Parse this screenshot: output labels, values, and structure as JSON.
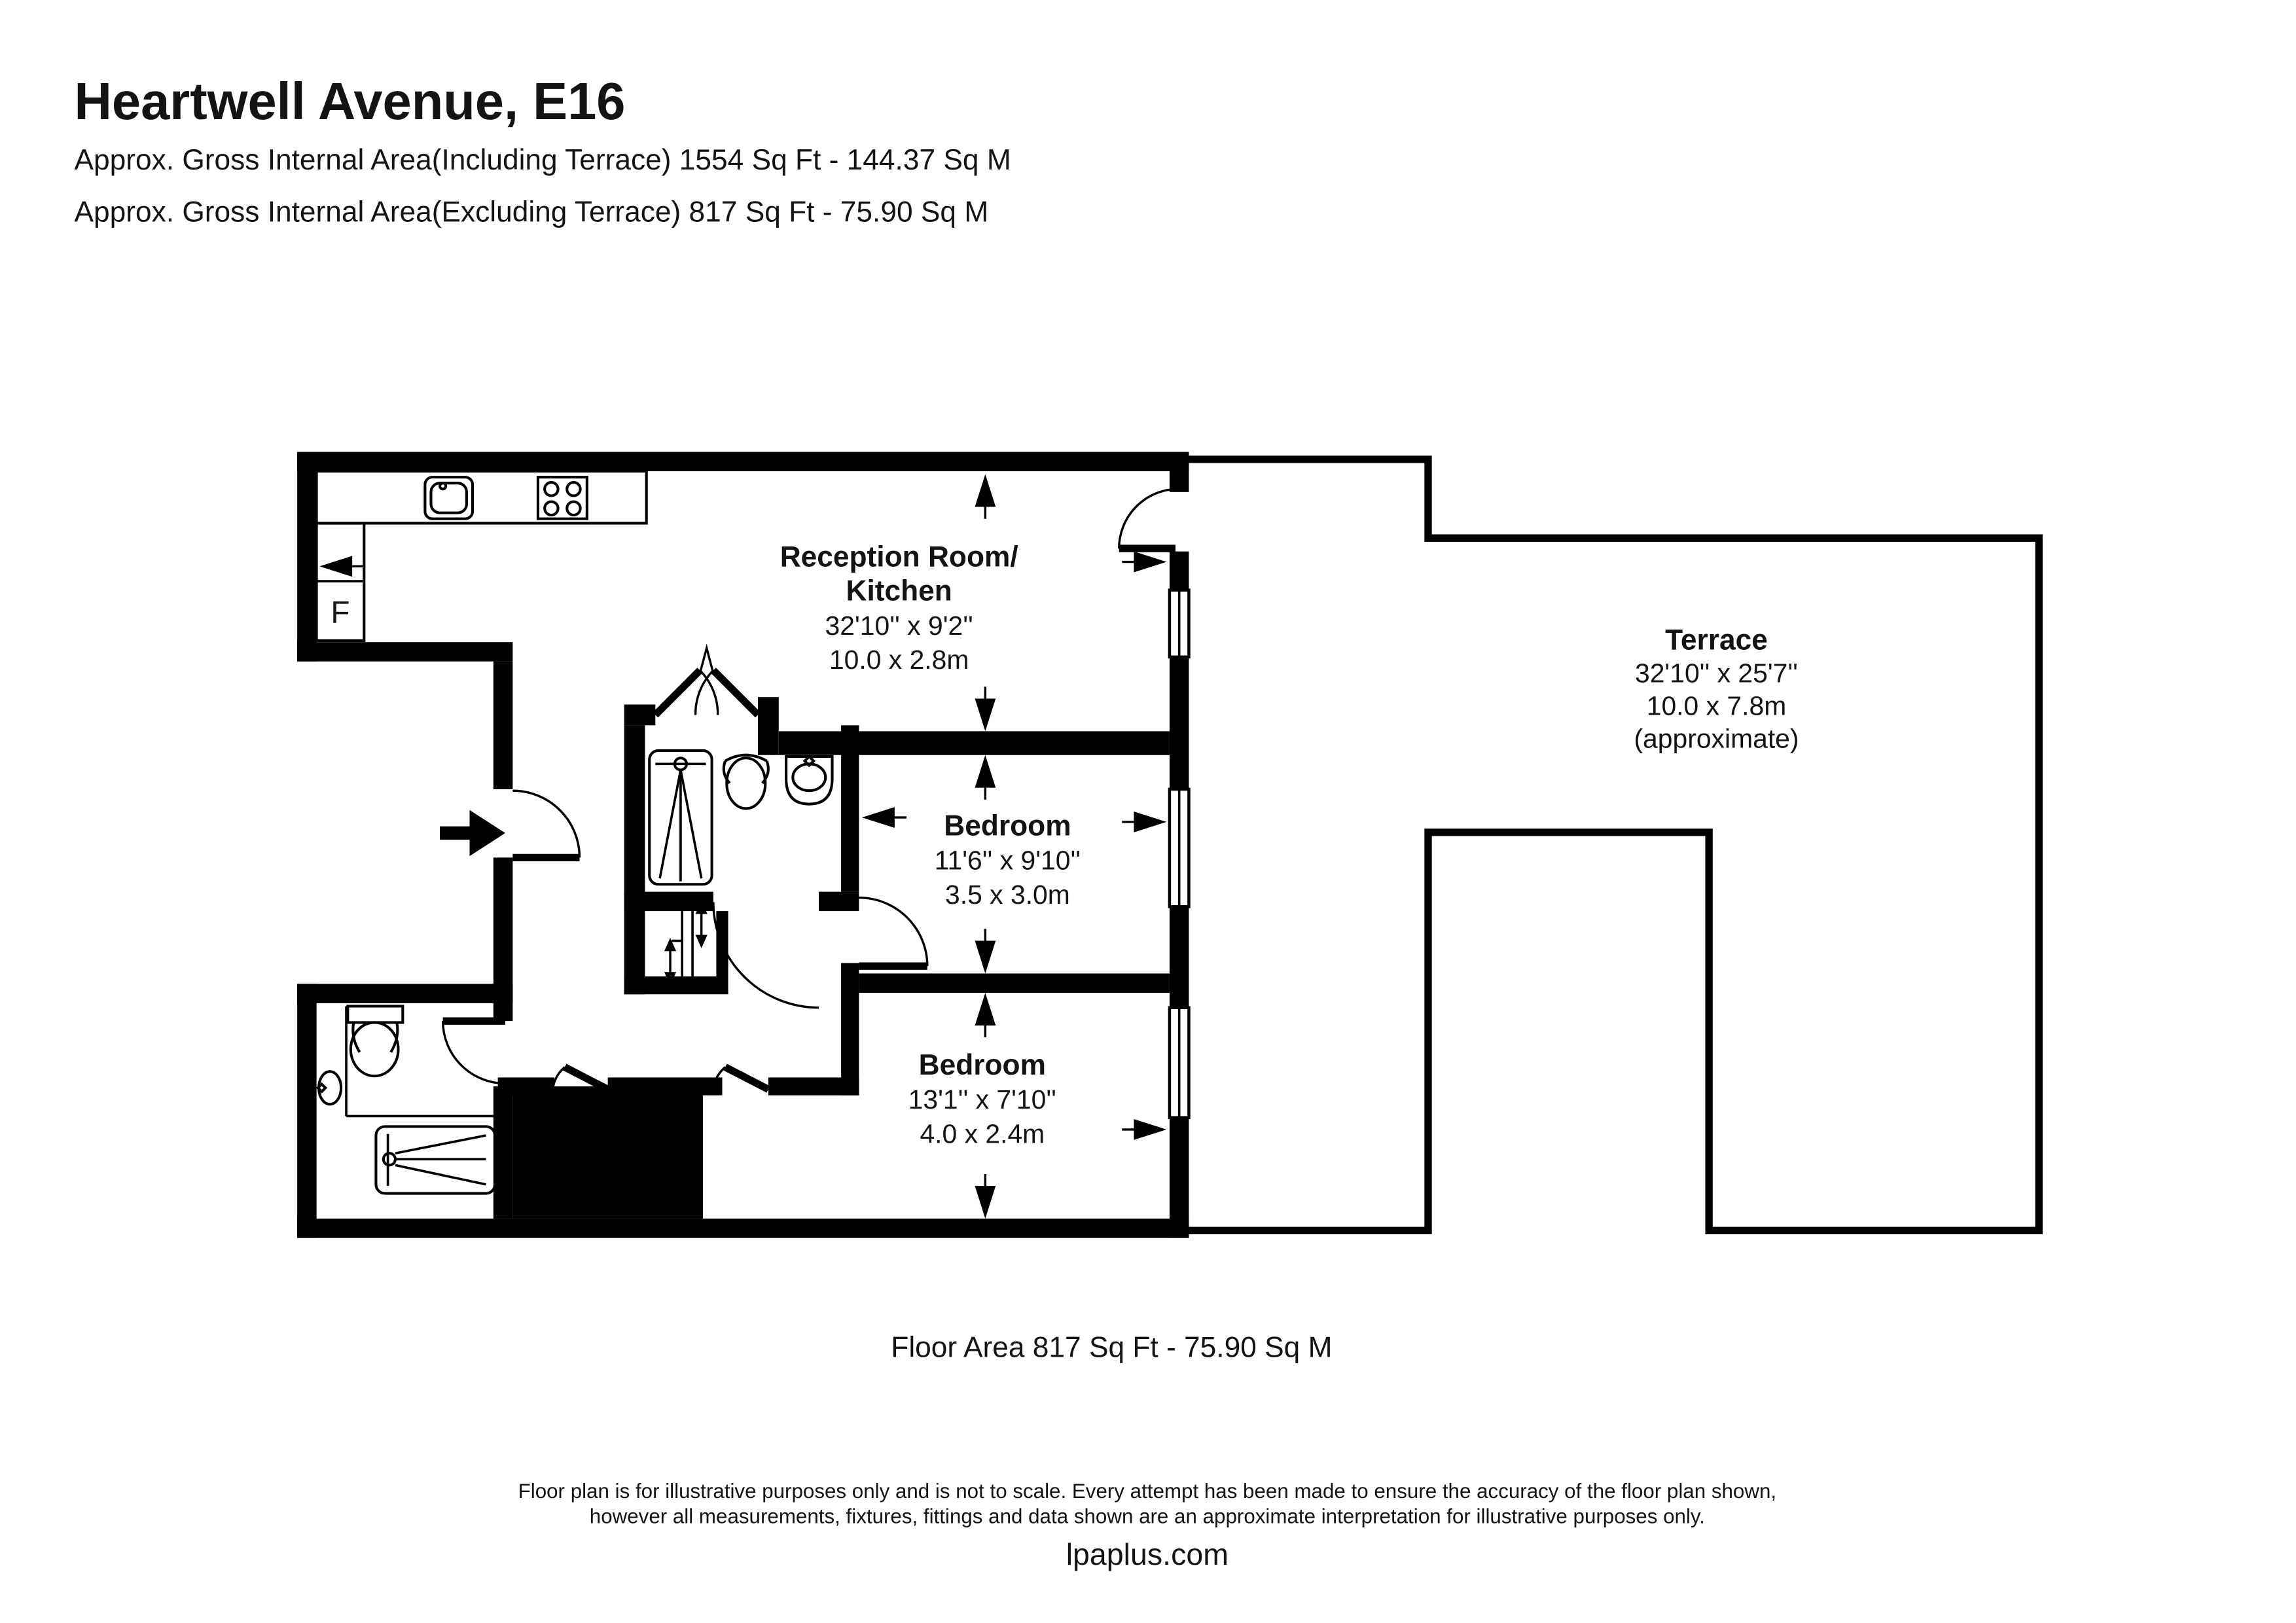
{
  "header": {
    "title": "Heartwell Avenue, E16",
    "subtitle1": "Approx. Gross Internal Area(Including Terrace) 1554 Sq Ft - 144.37 Sq M",
    "subtitle2": "Approx. Gross Internal Area(Excluding Terrace) 817 Sq Ft - 75.90 Sq M"
  },
  "rooms": {
    "reception": {
      "name_line1": "Reception Room/",
      "name_line2": "Kitchen",
      "dims_imperial": "32'10'' x 9'2''",
      "dims_metric": "10.0 x 2.8m"
    },
    "bedroom1": {
      "name": "Bedroom",
      "dims_imperial": "11'6'' x 9'10''",
      "dims_metric": "3.5 x 3.0m"
    },
    "bedroom2": {
      "name": "Bedroom",
      "dims_imperial": "13'1'' x 7'10''",
      "dims_metric": "4.0 x 2.4m"
    },
    "terrace": {
      "name": "Terrace",
      "dims_imperial": "32'10'' x 25'7''",
      "dims_metric": "10.0 x 7.8m",
      "note": "(approximate)"
    }
  },
  "labels": {
    "fridge": "F"
  },
  "footer": {
    "floor_area": "Floor Area 817 Sq Ft - 75.90 Sq M",
    "disclaimer_line1": "Floor plan is for illustrative purposes only and is not to scale. Every attempt has been made to ensure the accuracy of the floor plan shown,",
    "disclaimer_line2": "however all measurements, fixtures, fittings and data shown are an approximate interpretation for illustrative purposes only.",
    "website": "lpaplus.com"
  },
  "colors": {
    "walls": "#000000",
    "background": "#ffffff",
    "text": "#141414"
  }
}
